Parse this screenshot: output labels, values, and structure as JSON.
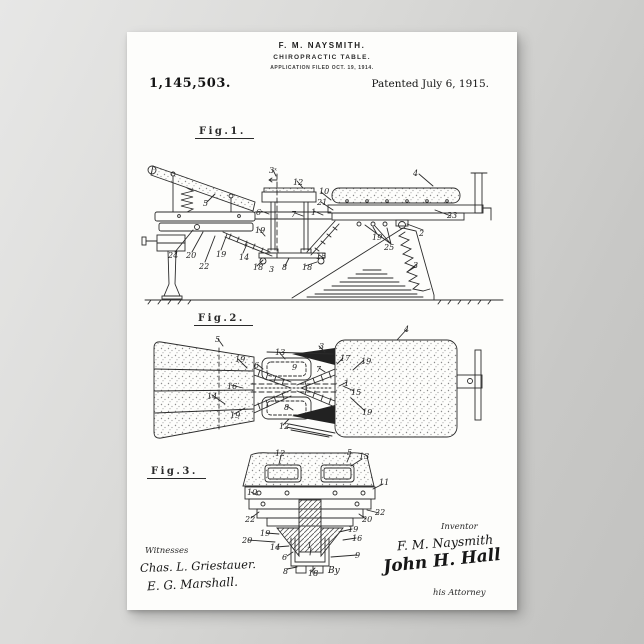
{
  "header": {
    "inventor_line": "F. M. NAYSMITH.",
    "title_line": "CHIROPRACTIC TABLE.",
    "application_line": "APPLICATION FILED OCT. 19, 1914.",
    "patent_number": "1,145,503.",
    "patent_date": "Patented July 6, 1915."
  },
  "figures": {
    "fig1": {
      "label": "Fig.1.",
      "numerals": [
        {
          "t": "5",
          "x": 68,
          "y": 76
        },
        {
          "t": "3ˣ",
          "x": 134,
          "y": 43
        },
        {
          "t": "12",
          "x": 158,
          "y": 55
        },
        {
          "t": "10",
          "x": 184,
          "y": 64
        },
        {
          "t": "21",
          "x": 182,
          "y": 75
        },
        {
          "t": "6",
          "x": 121,
          "y": 85
        },
        {
          "t": "7",
          "x": 156,
          "y": 87
        },
        {
          "t": "1",
          "x": 176,
          "y": 85
        },
        {
          "t": "4",
          "x": 278,
          "y": 46
        },
        {
          "t": "23",
          "x": 312,
          "y": 88
        },
        {
          "t": "2",
          "x": 284,
          "y": 106
        },
        {
          "t": "25",
          "x": 249,
          "y": 120
        },
        {
          "t": "19",
          "x": 237,
          "y": 110
        },
        {
          "t": "24",
          "x": 33,
          "y": 128
        },
        {
          "t": "20",
          "x": 51,
          "y": 128
        },
        {
          "t": "22",
          "x": 64,
          "y": 139
        },
        {
          "t": "19",
          "x": 81,
          "y": 127
        },
        {
          "t": "19",
          "x": 120,
          "y": 103
        },
        {
          "t": "14",
          "x": 104,
          "y": 130
        },
        {
          "t": "18",
          "x": 118,
          "y": 140
        },
        {
          "t": "3",
          "x": 134,
          "y": 142
        },
        {
          "t": "8",
          "x": 147,
          "y": 140
        },
        {
          "t": "18",
          "x": 167,
          "y": 140
        },
        {
          "t": "15",
          "x": 181,
          "y": 129
        },
        {
          "t": "3",
          "x": 278,
          "y": 138
        }
      ]
    },
    "fig2": {
      "label": "Fig.2.",
      "numerals": [
        {
          "t": "5",
          "x": 76,
          "y": 24
        },
        {
          "t": "19",
          "x": 96,
          "y": 44
        },
        {
          "t": "16",
          "x": 88,
          "y": 71
        },
        {
          "t": "14",
          "x": 68,
          "y": 81
        },
        {
          "t": "19",
          "x": 91,
          "y": 100
        },
        {
          "t": "13",
          "x": 136,
          "y": 37
        },
        {
          "t": "9",
          "x": 153,
          "y": 52
        },
        {
          "t": "6",
          "x": 115,
          "y": 50
        },
        {
          "t": "8",
          "x": 145,
          "y": 92
        },
        {
          "t": "12",
          "x": 140,
          "y": 111
        },
        {
          "t": "3",
          "x": 180,
          "y": 31
        },
        {
          "t": "7",
          "x": 177,
          "y": 54
        },
        {
          "t": "17",
          "x": 201,
          "y": 43
        },
        {
          "t": "19",
          "x": 222,
          "y": 46
        },
        {
          "t": "1",
          "x": 205,
          "y": 68
        },
        {
          "t": "15",
          "x": 212,
          "y": 77
        },
        {
          "t": "19",
          "x": 223,
          "y": 97
        },
        {
          "t": "4",
          "x": 265,
          "y": 14
        }
      ]
    },
    "fig3": {
      "label": "Fig.3.",
      "numerals": [
        {
          "t": "12",
          "x": 136,
          "y": 2
        },
        {
          "t": "5",
          "x": 208,
          "y": 1
        },
        {
          "t": "13",
          "x": 220,
          "y": 5
        },
        {
          "t": "10",
          "x": 108,
          "y": 41
        },
        {
          "t": "11",
          "x": 240,
          "y": 31
        },
        {
          "t": "22",
          "x": 106,
          "y": 68
        },
        {
          "t": "22",
          "x": 236,
          "y": 61
        },
        {
          "t": "20",
          "x": 223,
          "y": 68
        },
        {
          "t": "19",
          "x": 209,
          "y": 78
        },
        {
          "t": "16",
          "x": 213,
          "y": 87
        },
        {
          "t": "19",
          "x": 121,
          "y": 82
        },
        {
          "t": "20",
          "x": 103,
          "y": 89
        },
        {
          "t": "14",
          "x": 131,
          "y": 96
        },
        {
          "t": "1",
          "x": 168,
          "y": 94
        },
        {
          "t": "6",
          "x": 143,
          "y": 106
        },
        {
          "t": "9",
          "x": 216,
          "y": 104
        },
        {
          "t": "8",
          "x": 144,
          "y": 120
        },
        {
          "t": "18",
          "x": 169,
          "y": 122
        }
      ]
    }
  },
  "signatures": {
    "witnesses_label": "Witnesses",
    "witnesses": [
      "Chas. L. Griestauer.",
      "E. G. Marshall."
    ],
    "inventor_label": "Inventor",
    "inventor_signature": "F. M. Naysmith",
    "by_label": "By",
    "attorney_signature": "John H. Hall",
    "attorney_label": "his Attorney"
  },
  "colors": {
    "ink": "#2b2b2b",
    "paper": "#fdfdfb",
    "wall": "#c8c8c6"
  }
}
